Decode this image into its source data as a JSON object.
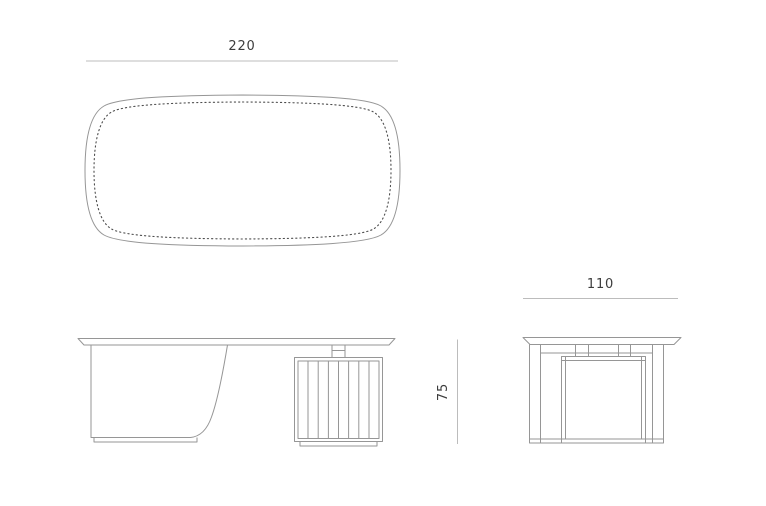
{
  "drawing": {
    "type": "furniture-dimension-drawing",
    "views": {
      "top_view": {
        "name": "desk top view (plan) with stitched leather inlay outline"
      },
      "front_view": {
        "name": "desk front elevation with curved panel leg and slatted pedestal"
      },
      "side_view": {
        "name": "desk side elevation"
      }
    },
    "dimensions": {
      "length": {
        "value": "220",
        "orientation": "horizontal",
        "applies_to": "top view width"
      },
      "depth": {
        "value": "110",
        "orientation": "horizontal",
        "applies_to": "side view width"
      },
      "height": {
        "value": "75",
        "orientation": "vertical",
        "applies_to": "side view height"
      }
    },
    "colors": {
      "outline": "#969696",
      "stitch_dots": "#4d4d4d",
      "dimension_line": "#bcbcbc",
      "dimension_text": "#3d3d3d",
      "background": "#ffffff"
    }
  }
}
